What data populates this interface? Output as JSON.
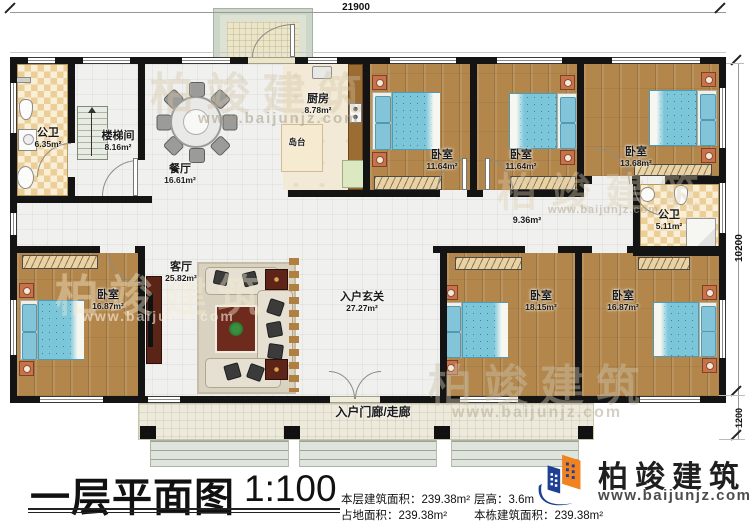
{
  "plan": {
    "dimensions": {
      "width": "21900",
      "height": "10200",
      "porch": "1200"
    },
    "rooms": [
      {
        "name": "公卫",
        "area": "6.35m²"
      },
      {
        "name": "楼梯间",
        "area": "8.16m²"
      },
      {
        "name": "餐厅",
        "area": "16.61m²"
      },
      {
        "name": "厨房",
        "area": "8.78m²"
      },
      {
        "name": "岛台"
      },
      {
        "name": "卧室",
        "area": "11.64m²"
      },
      {
        "name": "卧室",
        "area": "11.64m²"
      },
      {
        "name": "卧室",
        "area": "13.68m²"
      },
      {
        "area": "9.36m²"
      },
      {
        "name": "公卫",
        "area": "5.11m²"
      },
      {
        "name": "卧室",
        "area": "16.87m²"
      },
      {
        "name": "客厅",
        "area": "25.82m²"
      },
      {
        "name": "入户玄关",
        "area": "27.27m²"
      },
      {
        "name": "卧室",
        "area": "18.15m²"
      },
      {
        "name": "卧室",
        "area": "16.87m²"
      },
      {
        "name": "入户门廊/走廊"
      }
    ]
  },
  "titleblock": {
    "title": "一层平面图",
    "scale": "1:100",
    "stats": [
      {
        "label": "本层建筑面积：",
        "value": "239.38m²"
      },
      {
        "label": "占地面积：",
        "value": "239.38m²"
      },
      {
        "label": "层高：",
        "value": "3.6m"
      },
      {
        "label": "本栋建筑面积：",
        "value": "239.38m²"
      }
    ]
  },
  "brand": {
    "name": "柏竣建筑",
    "url": "www.baijunjz.com"
  },
  "watermark": {
    "text": "柏竣建筑",
    "url": "www.baijunjz.com"
  },
  "colors": {
    "wall": "#141414",
    "wood": "#b3874c",
    "bed": "#7cc6da",
    "tile": "#eccf98",
    "brand_blue": "#1d3f94",
    "brand_orange": "#f08220"
  }
}
